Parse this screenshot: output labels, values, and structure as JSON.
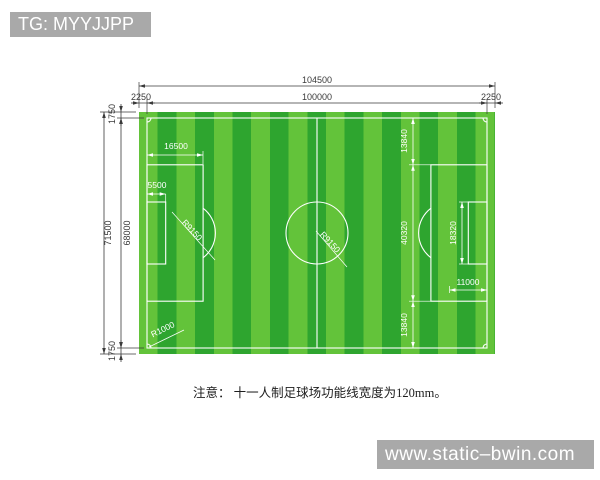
{
  "banners": {
    "top_left": "TG: MYYJJPP",
    "bottom_right": "www.static–bwin.com"
  },
  "note": "注意： 十一人制足球场功能线宽度为120mm。",
  "colors": {
    "stripe_light": "#63c33a",
    "stripe_dark": "#2ea52f",
    "field_line": "#ffffff",
    "banner_bg": "#a9a9a9",
    "dimension_text": "#3a3a3a"
  },
  "dims": {
    "total_width": "104500",
    "field_width": "100000",
    "margin_left": "2250",
    "margin_right": "2250",
    "total_height": "71500",
    "field_height": "68000",
    "margin_top": "1750",
    "margin_bottom": "1750",
    "penalty_depth": "16500",
    "goal_depth": "5500",
    "penalty_arc_radius": "R9150",
    "center_circle_radius": "R9150",
    "penalty_top_offset": "13840",
    "penalty_width": "40320",
    "goal_width": "18320",
    "penalty_spot_dist": "11000",
    "penalty_bottom_offset": "13840",
    "corner_arc_radius": "R1000"
  }
}
